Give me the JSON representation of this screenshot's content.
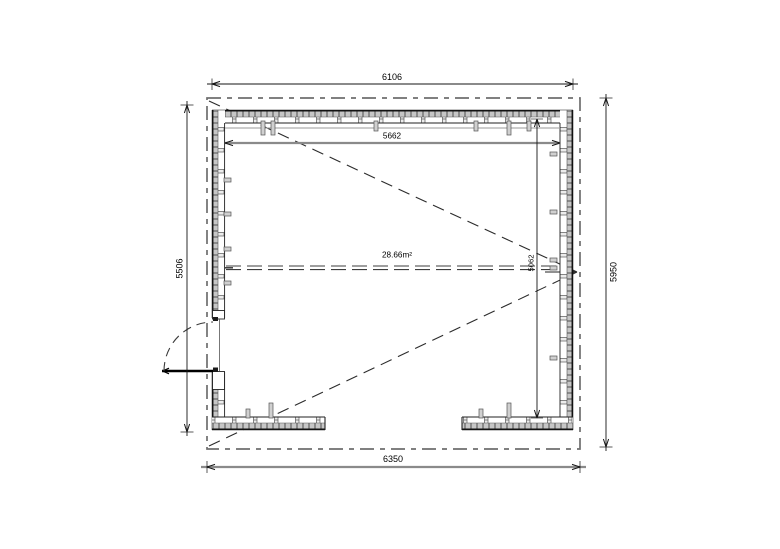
{
  "plan": {
    "area_label": "28.66m²",
    "dimensions": {
      "overall_width_top": "6106",
      "overall_width_bottom": "6350",
      "overall_height_left": "5506",
      "overall_height_right": "5950",
      "interior_width": "5662",
      "interior_depth": "5062"
    },
    "colors": {
      "line_black": "#161616",
      "dim_gray": "#8a8a8a",
      "roof_dash_gray": "#6e6e6e",
      "wall_hatch_fill": "#c6c6c6"
    }
  }
}
